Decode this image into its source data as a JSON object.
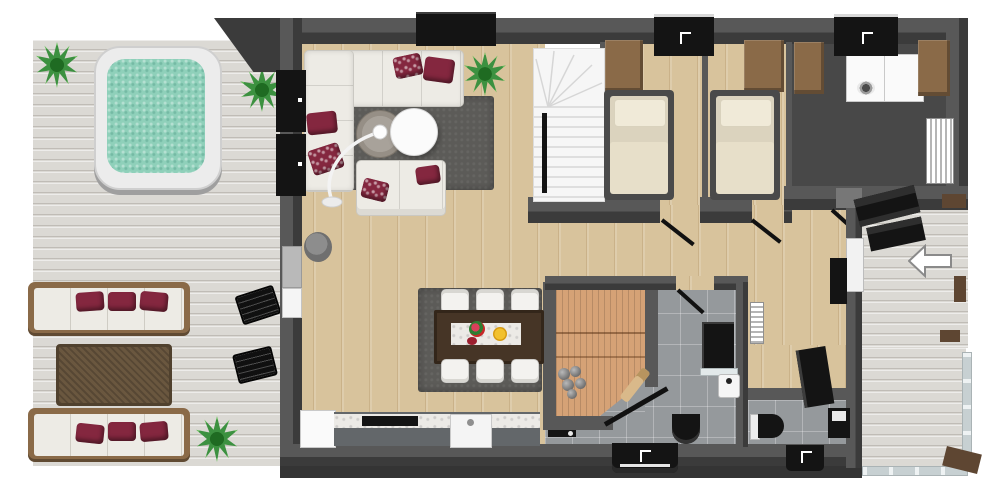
{
  "palette": {
    "patio": "#dbd9d4",
    "wood": "#d8c39c",
    "tile": "#95999c",
    "utility": "#484848",
    "wall": "#585858",
    "wall-dark": "#3b3b3b",
    "sauna-wood": "#d5a276",
    "teal-water": "#8fd0ba",
    "burgundy": "#84273f",
    "cream": "#edebe5",
    "rug": "#5c5b58",
    "brown-wood": "#8a6a48",
    "table-brown": "#463526",
    "mattress": "#e7dfc9",
    "black": "#141414",
    "plant": "#3c9140",
    "glass": "#c7d0d2",
    "white": "#ffffff"
  },
  "scene": {
    "type": "3d-floorplan-top-view",
    "entry_arrow": {
      "direction": "left"
    },
    "outdoor_left_patio": {
      "floor": "whitewashed-wood-planks",
      "items": [
        "hot-tub",
        "plant",
        "plant",
        "plant",
        "outdoor-sofa-3seat",
        "outdoor-coffee-table",
        "outdoor-sofa-3seat",
        "wall-bar-counter",
        "bar-chair",
        "bar-chair"
      ]
    },
    "rooms": [
      {
        "name": "living-room",
        "floor": "oak-planks",
        "items": [
          "corner-sofa",
          "loveseat",
          "area-rug",
          "round-coffee-table-gray",
          "round-coffee-table-white",
          "arc-floor-lamp",
          "wall-tv",
          "media-cabinets",
          "potted-plant",
          "stool"
        ]
      },
      {
        "name": "dining-area",
        "floor": "oak-planks",
        "items": [
          "dining-table",
          "table-runner",
          "flowers",
          "fruit-bowl",
          "chair-x6",
          "area-rug"
        ]
      },
      {
        "name": "kitchen",
        "floor": "oak-planks",
        "items": [
          "fridge",
          "counter-with-marble-top",
          "cooktop",
          "sink"
        ]
      },
      {
        "name": "staircase",
        "items": [
          "winder-stairs",
          "handrail"
        ]
      },
      {
        "name": "bedroom-1",
        "floor": "oak-planks",
        "items": [
          "single-bed",
          "wardrobe",
          "wall-vanity-sink",
          "door"
        ]
      },
      {
        "name": "bedroom-2",
        "floor": "oak-planks",
        "items": [
          "single-bed",
          "wardrobe",
          "door"
        ]
      },
      {
        "name": "utility-room",
        "floor": "dark-gray",
        "items": [
          "washer",
          "dryer",
          "cabinet",
          "cabinet",
          "wall-vanity-sink",
          "radiator",
          "door"
        ]
      },
      {
        "name": "hallway",
        "floor": "oak-planks",
        "items": [
          "radiator",
          "shoe-cabinet",
          "console-desk"
        ]
      },
      {
        "name": "sauna",
        "items": [
          "cedar-benches",
          "sauna-stones",
          "glass-door",
          "sauna-whisk"
        ]
      },
      {
        "name": "bathroom",
        "floor": "gray-tile",
        "items": [
          "shower",
          "corner-sink",
          "wall-hung-toilet",
          "black-vanity-sink",
          "door"
        ]
      },
      {
        "name": "wc",
        "floor": "gray-tile",
        "items": [
          "toilet",
          "washbasin",
          "black-vanity-sink"
        ]
      },
      {
        "name": "entry-porch",
        "floor": "whitewashed-wood-planks",
        "items": [
          "outdoor-bench-set",
          "entry-door",
          "roof-posts",
          "direction-arrow"
        ]
      },
      {
        "name": "rear-deck",
        "floor": "whitewashed-wood-planks",
        "items": [
          "glass-railing",
          "corner-post"
        ]
      }
    ]
  }
}
